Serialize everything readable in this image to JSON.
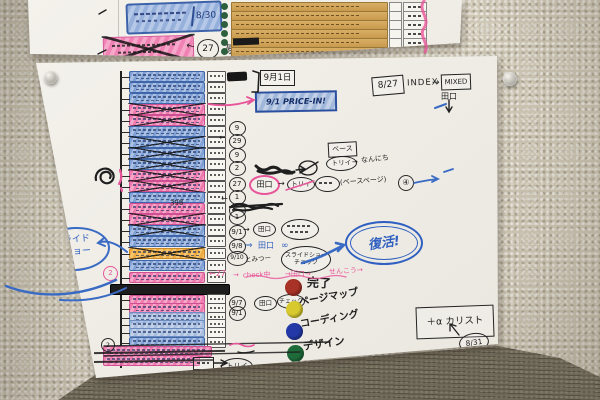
{
  "sym": {
    "right": "→",
    "left": "←",
    "down": "↓",
    "dbl": "⇒"
  },
  "top_paper": {
    "spring_date": "8/30",
    "circle_27": "27",
    "genkou": "原稿",
    "table_rows": [
      2,
      11,
      20,
      29,
      38,
      47
    ]
  },
  "header_notes": {
    "date_box": "8/27",
    "index": "INDEX",
    "mixed": "MIXED",
    "taguchi": "田口",
    "sep1": "9月1日",
    "price_in": "9/1 PRICE-IN!"
  },
  "flow": {
    "base": "ベース",
    "torii": "トリイ",
    "nannichi": "なんにち",
    "taguchi": "田口",
    "base_page": "(ベースページ)",
    "circle4": "④",
    "infinity": "∞",
    "tomitsu": "とみつー",
    "slideshow_check": "スライドショー チェック",
    "fukkatsu": "復活!",
    "pink_left": "←27",
    "pink_check": "check中",
    "pink_taguchi": "→田口→",
    "pink_senkou": "せんこう→",
    "num398": "398",
    "check": "チェック",
    "circle2": "2"
  },
  "bubble": {
    "line1": "スライド",
    "line2": "ショー"
  },
  "legend": {
    "items": [
      {
        "color": "#a93226",
        "label": "完了"
      },
      {
        "color": "#d8ca2e",
        "label": "ページマップ"
      },
      {
        "color": "#2439a8",
        "label": "コーディング"
      },
      {
        "color": "#1e6b3a",
        "label": "デザイン"
      }
    ]
  },
  "plus_alpha": {
    "box": "＋α カリスト",
    "date": "8/31"
  },
  "rows": [
    {
      "y": 71,
      "c": "b"
    },
    {
      "y": 82,
      "c": "b"
    },
    {
      "y": 93,
      "c": "b"
    },
    {
      "y": 104,
      "c": "p",
      "x": 1
    },
    {
      "y": 115,
      "c": "p",
      "x": 1
    },
    {
      "y": 126,
      "c": "b"
    },
    {
      "y": 137,
      "c": "b",
      "x": 1
    },
    {
      "y": 148,
      "c": "b",
      "x": 1
    },
    {
      "y": 159,
      "c": "b",
      "x": 1
    },
    {
      "y": 170,
      "c": "p",
      "x": 1
    },
    {
      "y": 181,
      "c": "p",
      "x": 1
    },
    {
      "y": 192,
      "c": "b"
    },
    {
      "y": 203,
      "c": "p"
    },
    {
      "y": 214,
      "c": "p",
      "x": 1
    },
    {
      "y": 225,
      "c": "b",
      "x": 1
    },
    {
      "y": 236,
      "c": "b"
    },
    {
      "y": 248,
      "c": "o",
      "x": 1
    },
    {
      "y": 260,
      "c": "b"
    },
    {
      "y": 272,
      "c": "p"
    },
    {
      "y": 284,
      "c": "k",
      "b": 0,
      "xpos": 110,
      "w": 118
    },
    {
      "y": 295,
      "c": "p",
      "h": 7
    },
    {
      "y": 303,
      "c": "p"
    },
    {
      "y": 312,
      "c": "b2"
    },
    {
      "y": 320,
      "c": "b2",
      "h": 7
    },
    {
      "y": 328,
      "c": "b2",
      "h": 7
    },
    {
      "y": 337,
      "c": "b"
    },
    {
      "y": 346,
      "c": "p",
      "s": 1,
      "xpos": 103,
      "w": 107,
      "b": 0
    },
    {
      "y": 355,
      "c": "p",
      "s": 1,
      "xpos": 103,
      "w": 95,
      "b": 0
    }
  ],
  "circles": [
    {
      "y": 127,
      "t": "9"
    },
    {
      "y": 140,
      "t": "29"
    },
    {
      "y": 154,
      "t": "9"
    },
    {
      "y": 167,
      "t": "2"
    },
    {
      "y": 183,
      "t": "27"
    },
    {
      "y": 196,
      "t": "1"
    },
    {
      "y": 209,
      "t": "",
      "scrib": 1
    },
    {
      "y": 216,
      "t": "1"
    },
    {
      "y": 231,
      "t": "9/1"
    },
    {
      "y": 245,
      "t": "9/8"
    },
    {
      "y": 257,
      "t": "9/10",
      "w": 19
    },
    {
      "y": 302,
      "t": "9/7"
    },
    {
      "y": 312,
      "t": "9/1"
    },
    {
      "y": 365,
      "t": "トリイ",
      "x": 221,
      "w": 30,
      "h": 15
    }
  ]
}
